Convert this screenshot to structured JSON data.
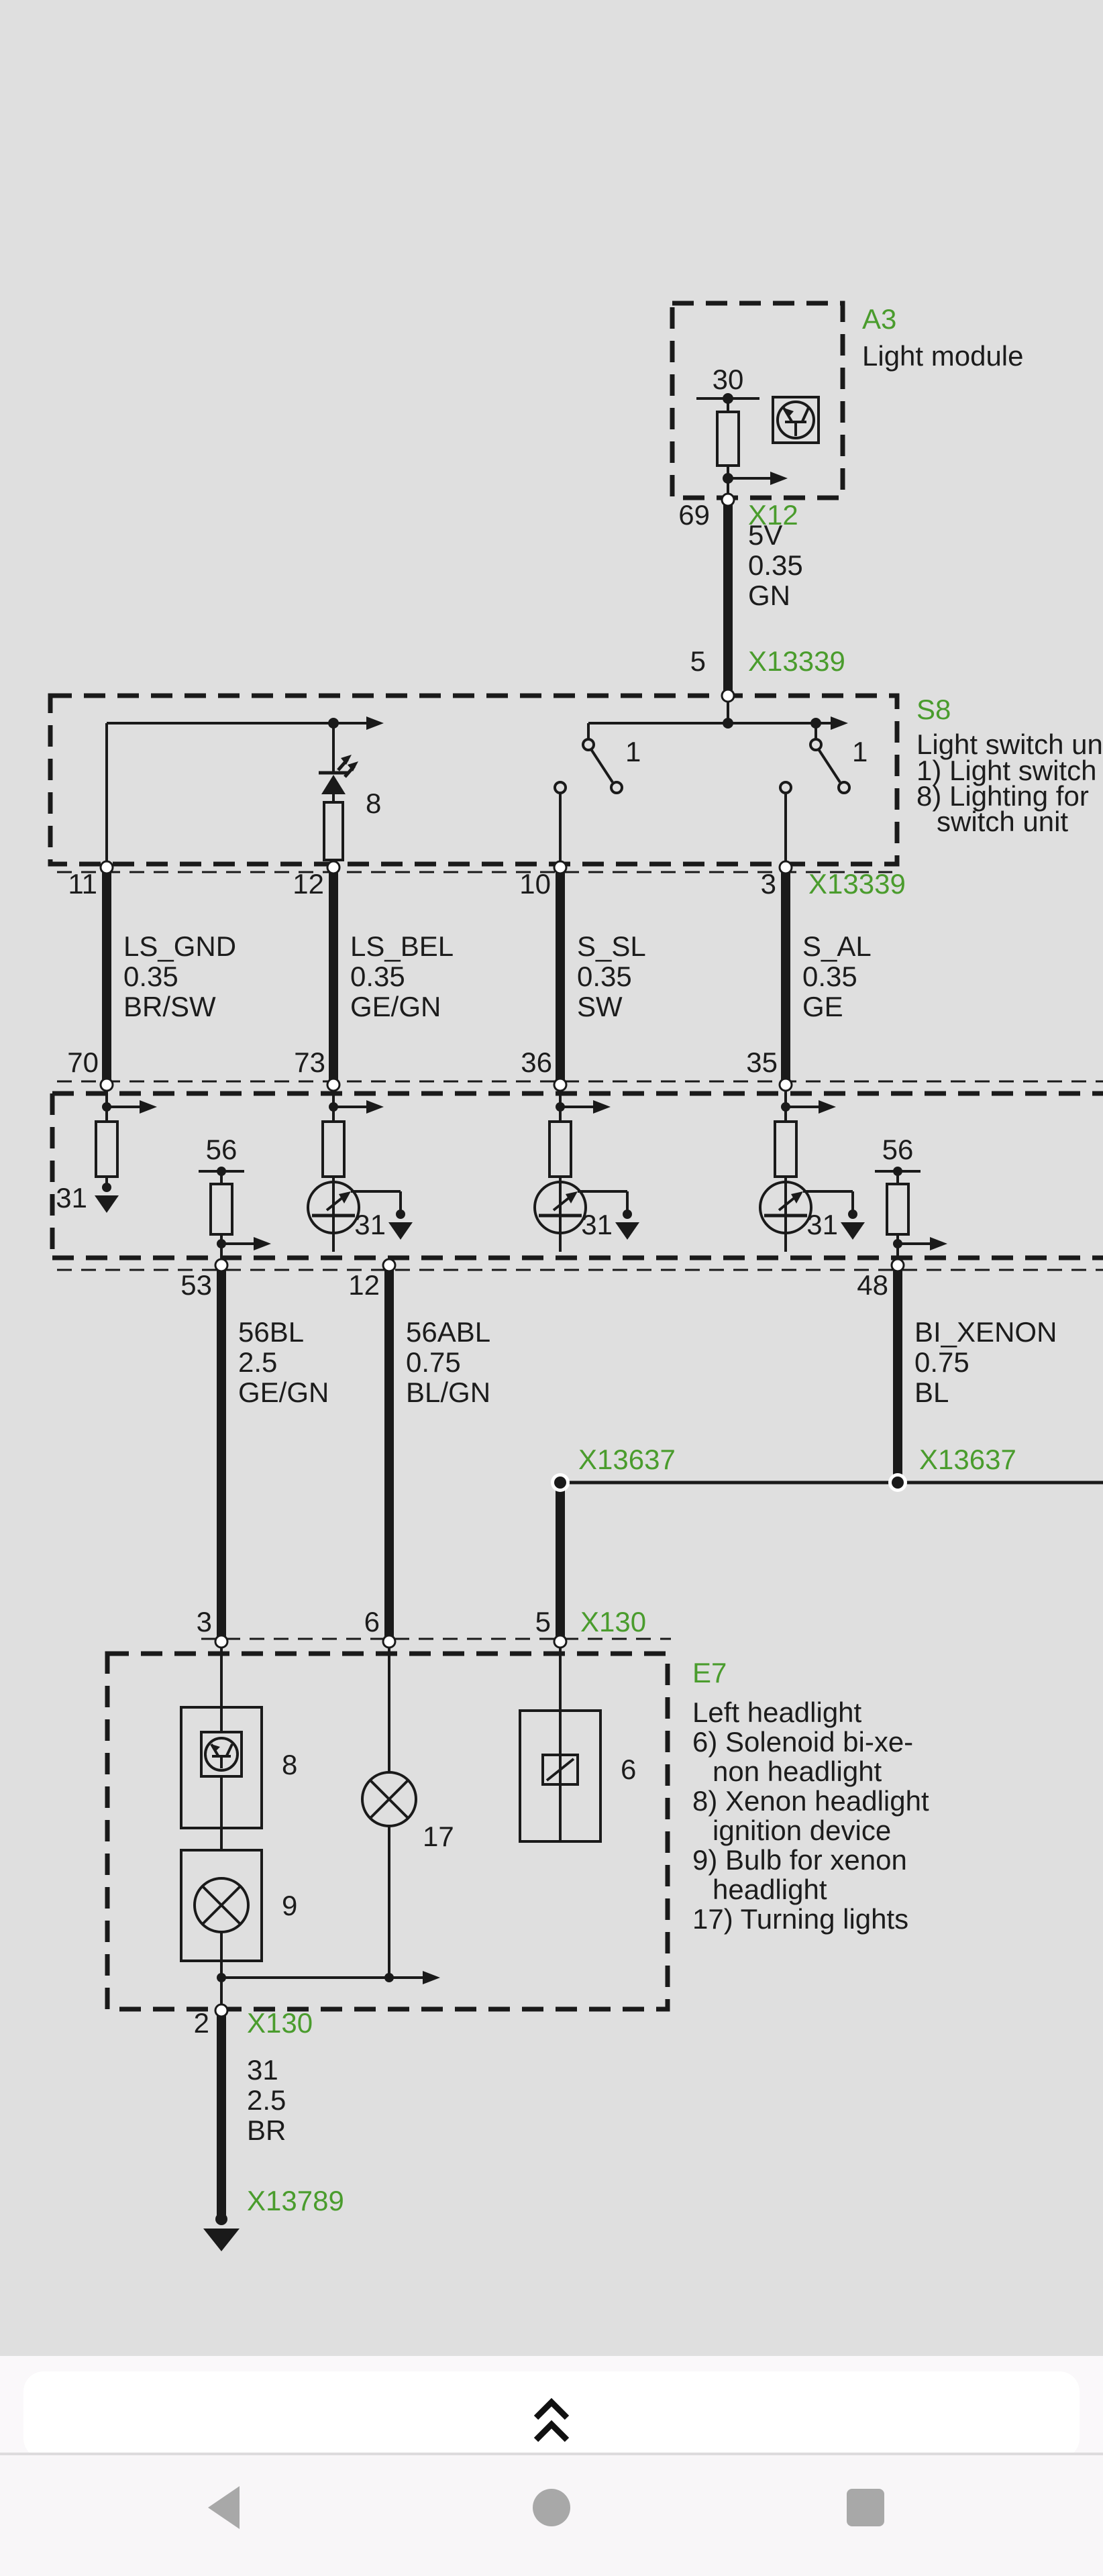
{
  "colors": {
    "background": "#dfdfdf",
    "line": "#1a1a1a",
    "accent_green": "#4a9c2d",
    "nav_icon": "#a8a8a8",
    "sheet": "#ffffff"
  },
  "modules": {
    "a3": {
      "code": "A3",
      "title": "Light module",
      "terminal_30": "30",
      "pin_out": "69"
    },
    "s8": {
      "code": "S8",
      "desc_line1": "Light switch unit",
      "desc_line2": "1) Light switch",
      "desc_line3": "8) Lighting for",
      "desc_line4": "switch unit",
      "lamp_label": "8",
      "switch_label": "1"
    },
    "e7": {
      "code": "E7",
      "desc_line1": "Left headlight",
      "desc_line2": "6) Solenoid bi-xe-",
      "desc_line3": "non headlight",
      "desc_line4": "8) Xenon headlight",
      "desc_line5": "ignition device",
      "desc_line6": "9) Bulb for xenon",
      "desc_line7": "headlight",
      "desc_line8": "17) Turning lights",
      "igniter_label": "8",
      "bulb_label": "9",
      "turn_label": "17",
      "solenoid_label": "6"
    }
  },
  "connectors": {
    "x12": "X12",
    "x13339": "X13339",
    "x13637": "X13637",
    "x130": "X130",
    "x13789": "X13789"
  },
  "terminals": {
    "t31": "31",
    "t56": "56"
  },
  "wires": {
    "feed": {
      "pin": "5",
      "name": "5V",
      "gauge": "0.35",
      "color": "GN"
    },
    "w11": {
      "pin": "11",
      "module_pin": "70",
      "name": "LS_GND",
      "gauge": "0.35",
      "color": "BR/SW"
    },
    "w12": {
      "pin": "12",
      "module_pin": "73",
      "name": "LS_BEL",
      "gauge": "0.35",
      "color": "GE/GN"
    },
    "w10": {
      "pin": "10",
      "module_pin": "36",
      "name": "S_SL",
      "gauge": "0.35",
      "color": "SW"
    },
    "w3": {
      "pin": "3",
      "module_pin": "35",
      "name": "S_AL",
      "gauge": "0.35",
      "color": "GE"
    },
    "w53": {
      "pin": "53",
      "e7_pin": "3",
      "name": "56BL",
      "gauge": "2.5",
      "color": "GE/GN"
    },
    "w12b": {
      "pin": "12",
      "e7_pin": "6",
      "name": "56ABL",
      "gauge": "0.75",
      "color": "BL/GN"
    },
    "w48": {
      "pin": "48",
      "e7_pin": "5",
      "name": "BI_XENON",
      "gauge": "0.75",
      "color": "BL"
    },
    "ground": {
      "pin": "2",
      "name": "31",
      "gauge": "2.5",
      "color": "BR"
    }
  },
  "bottom_bar": {
    "expand_icon": "chevron-double-up"
  },
  "nav_bar": {
    "back_icon": "triangle-left",
    "home_icon": "circle",
    "recents_icon": "square"
  }
}
